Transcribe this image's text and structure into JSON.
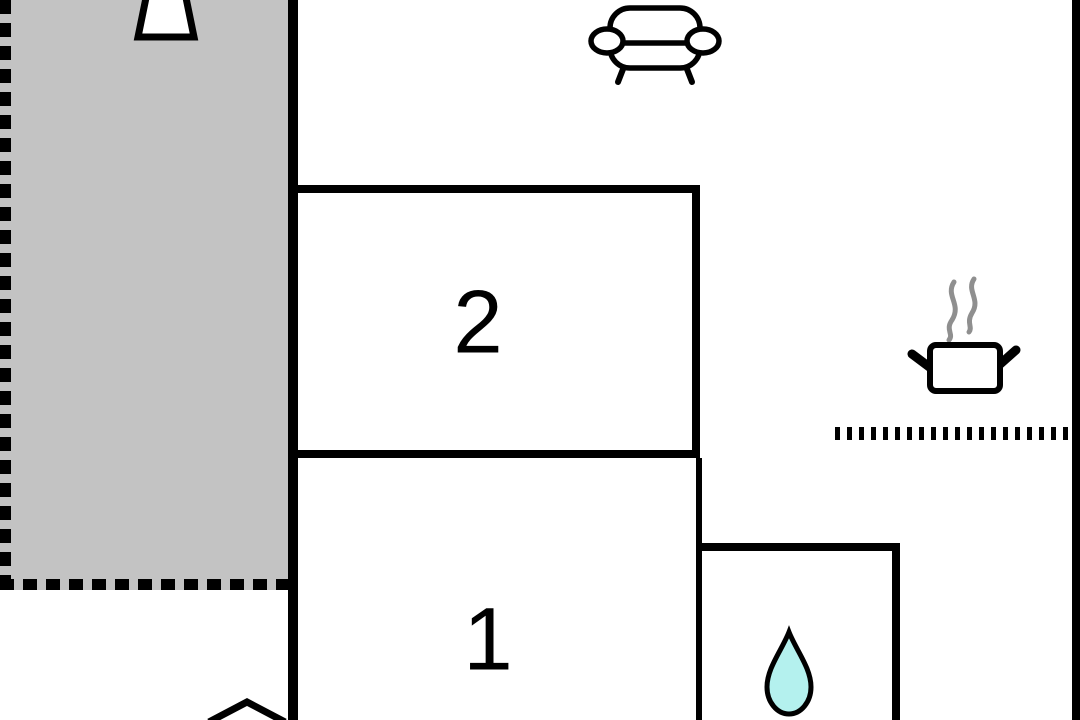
{
  "floorplan": {
    "rooms": [
      {
        "name": "room-2",
        "label": "2"
      },
      {
        "name": "room-1",
        "label": "1"
      }
    ],
    "icons": [
      {
        "name": "parasol-icon",
        "area": "terrace"
      },
      {
        "name": "sofa-icon",
        "area": "living-area"
      },
      {
        "name": "cooking-pot-icon",
        "area": "kitchen"
      },
      {
        "name": "water-drop-icon",
        "area": "bathroom"
      },
      {
        "name": "entrance-arrow-icon",
        "area": "bottom-edge"
      }
    ],
    "colors": {
      "background": "#ffffff",
      "wall": "#000000",
      "terrace_fill": "#c3c3c3",
      "steam_gray": "#8f8f8f",
      "water_drop_fill": "#b4f1ee"
    }
  }
}
